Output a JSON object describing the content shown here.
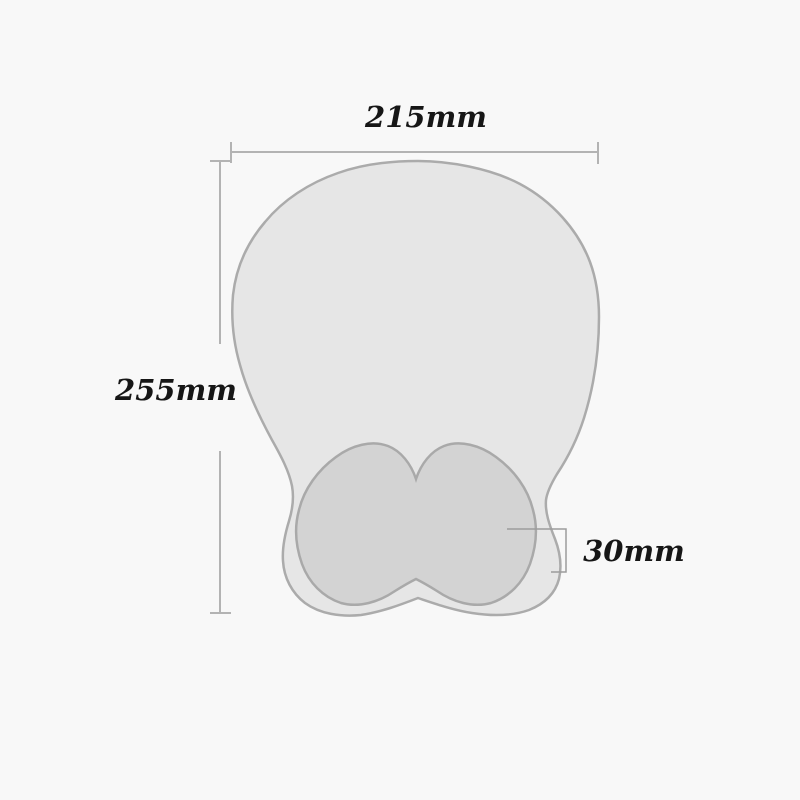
{
  "diagram": {
    "dimensions": {
      "width": "215mm",
      "height": "255mm",
      "thickness": "30mm"
    },
    "colors": {
      "background": "#f8f8f8",
      "pad_fill": "#e6e6e6",
      "pad_outline": "#ababab",
      "wrist_rest_fill": "#d3d3d3",
      "wrist_rest_outline": "#a9a9a9",
      "dimension_line": "#b3b3b3",
      "bracket_line": "#9c9c9c",
      "label_text": "#161616"
    }
  }
}
